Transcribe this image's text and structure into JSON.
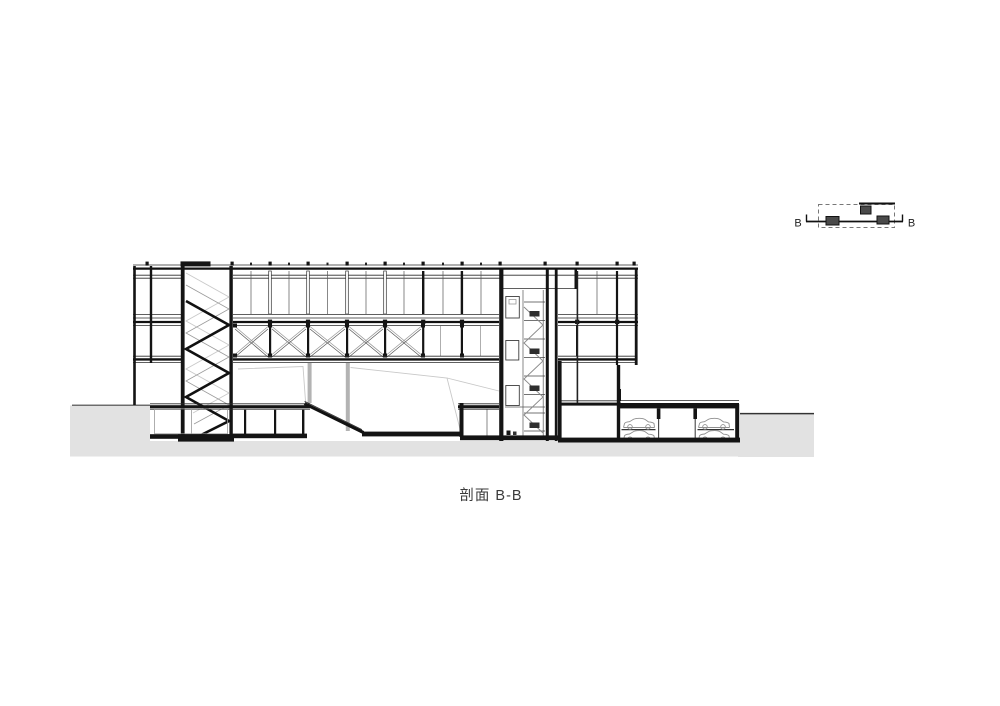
{
  "caption": "剖面 B-B",
  "key_plan": {
    "label_left": "B",
    "label_right": "B"
  },
  "colors": {
    "background": "#ffffff",
    "line": "#141414",
    "ground_fill": "#e2e2e2",
    "light_gray": "#c9c9c9",
    "keyplan_square": "#4a4a4a"
  }
}
